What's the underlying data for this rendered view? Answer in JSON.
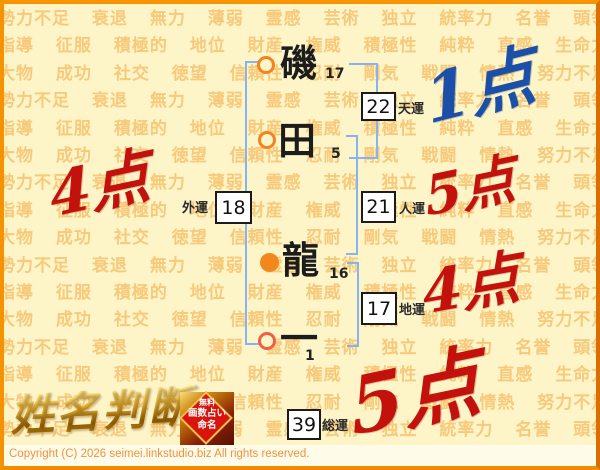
{
  "page": {
    "copyright": "Copyright (C) 2026 seimei.linkstudio.biz All rights reserved.",
    "logo_title": "姓名判断",
    "badge": {
      "line1": "無料",
      "line2": "画数占い",
      "line3": "命名"
    }
  },
  "name_column": {
    "characters": [
      {
        "char": "磯",
        "strokes": "17",
        "marker": "ring-orange"
      },
      {
        "char": "田",
        "strokes": "5",
        "marker": "ring-orange"
      },
      {
        "char": "龍",
        "strokes": "16",
        "marker": "disc-orange"
      },
      {
        "char": "一",
        "strokes": "1",
        "marker": "ring-red"
      }
    ]
  },
  "fortunes": {
    "tenun": {
      "label": "天運",
      "value": "22",
      "score": "1点",
      "score_color": "#1b4fa8"
    },
    "jinun": {
      "label": "人運",
      "value": "21",
      "score": "5点",
      "score_color": "#c3120c"
    },
    "chiun": {
      "label": "地運",
      "value": "17",
      "score": "4点",
      "score_color": "#c3120c"
    },
    "gaiun": {
      "label": "外運",
      "value": "18",
      "score": "4点",
      "score_color": "#c3120c"
    },
    "soun": {
      "label": "総運",
      "value": "39",
      "score": "5点",
      "score_color": "#c3120c"
    }
  },
  "background_words": [
    "勢力不足",
    "衰退",
    "無力",
    "薄弱",
    "霊感",
    "芸術",
    "独立",
    "統率力",
    "名誉",
    "頭領",
    "指導",
    "征服",
    "積極的",
    "地位",
    "財産",
    "権威",
    "積極性",
    "純粋",
    "直感",
    "生命力",
    "大物",
    "成功",
    "社交",
    "徳望",
    "信頼性",
    "忍耐",
    "剛気",
    "戦闘",
    "情熱",
    "努力不足"
  ],
  "colors": {
    "page_background": "#fdf5c8",
    "frame_border": "#f59200",
    "pattern_text": "#f2a63c",
    "bracket": "#86b4f2",
    "score_red": "#c3120c",
    "score_blue": "#1b4fa8",
    "marker_orange": "#f2831e",
    "marker_red": "#ee5f45",
    "logo_gold": "#c9980f",
    "badge_red": "#d8150d"
  }
}
